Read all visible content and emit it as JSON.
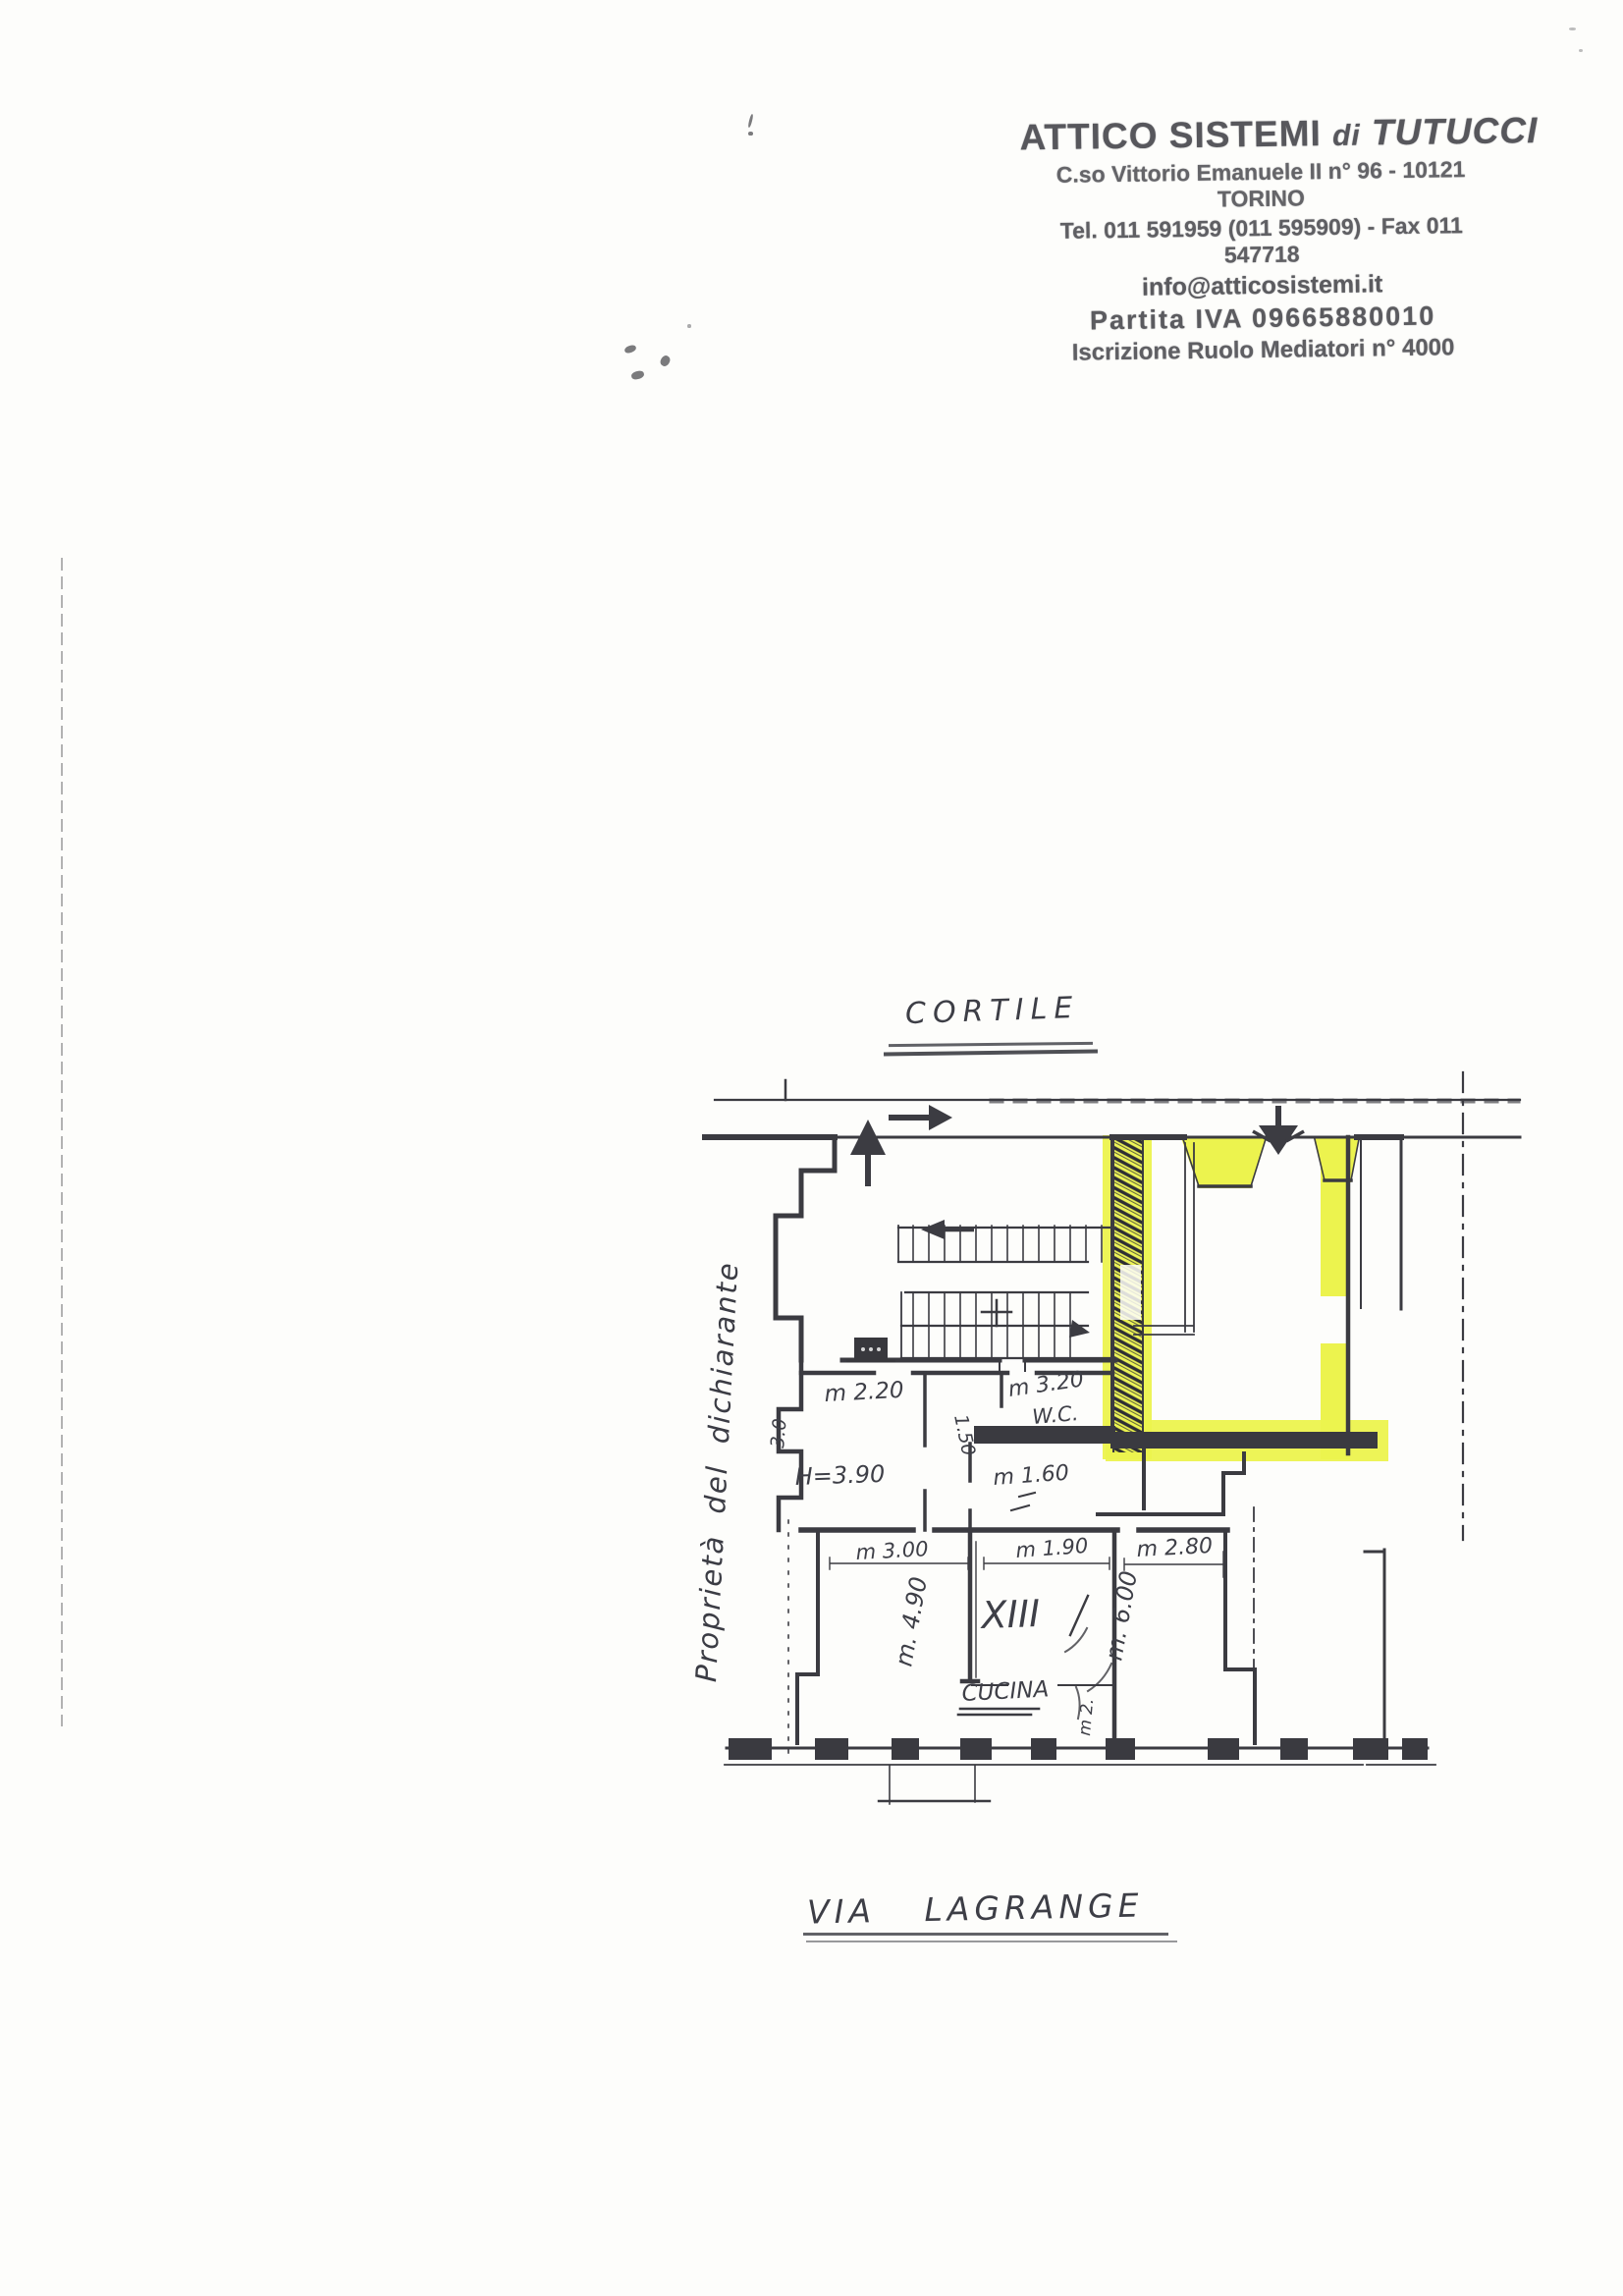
{
  "stamp": {
    "company": "ATTICO SISTEMI",
    "di": "di",
    "owner": "TUTUCCI",
    "address": "C.so Vittorio Emanuele II  n° 96 - 10121 TORINO",
    "phone_fax": "Tel. 011 591959 (011 595909) - Fax 011 547718",
    "email": "info@atticosistemi.it",
    "vat": "Partita IVA 09665880010",
    "register": "Iscrizione Ruolo Mediatori  n° 4000"
  },
  "labels": {
    "courtyard": "CORTILE",
    "street": "VIA LAGRANGE",
    "owner_note": "Proprietà del dichiarante"
  },
  "rooms": {
    "unit_number": "XIII",
    "kitchen": "CUCINA",
    "wc": "W.C."
  },
  "dimensions": {
    "d220": "m 2.20",
    "d320": "m 3.20",
    "h390": "H=3.90",
    "d160": "m 1.60",
    "v150": "1.50",
    "v30": "3.0",
    "d300": "m 3.00",
    "d190": "m 1.90",
    "d280": "m 2.80",
    "v490": "m. 4.90",
    "v600": "m. 6.00",
    "v2": "m 2."
  },
  "colors": {
    "highlight": "#ecf34e",
    "ink": "#3b3b41",
    "stamp_ink": "#4a4a4f",
    "pen": "#3d3e46"
  }
}
